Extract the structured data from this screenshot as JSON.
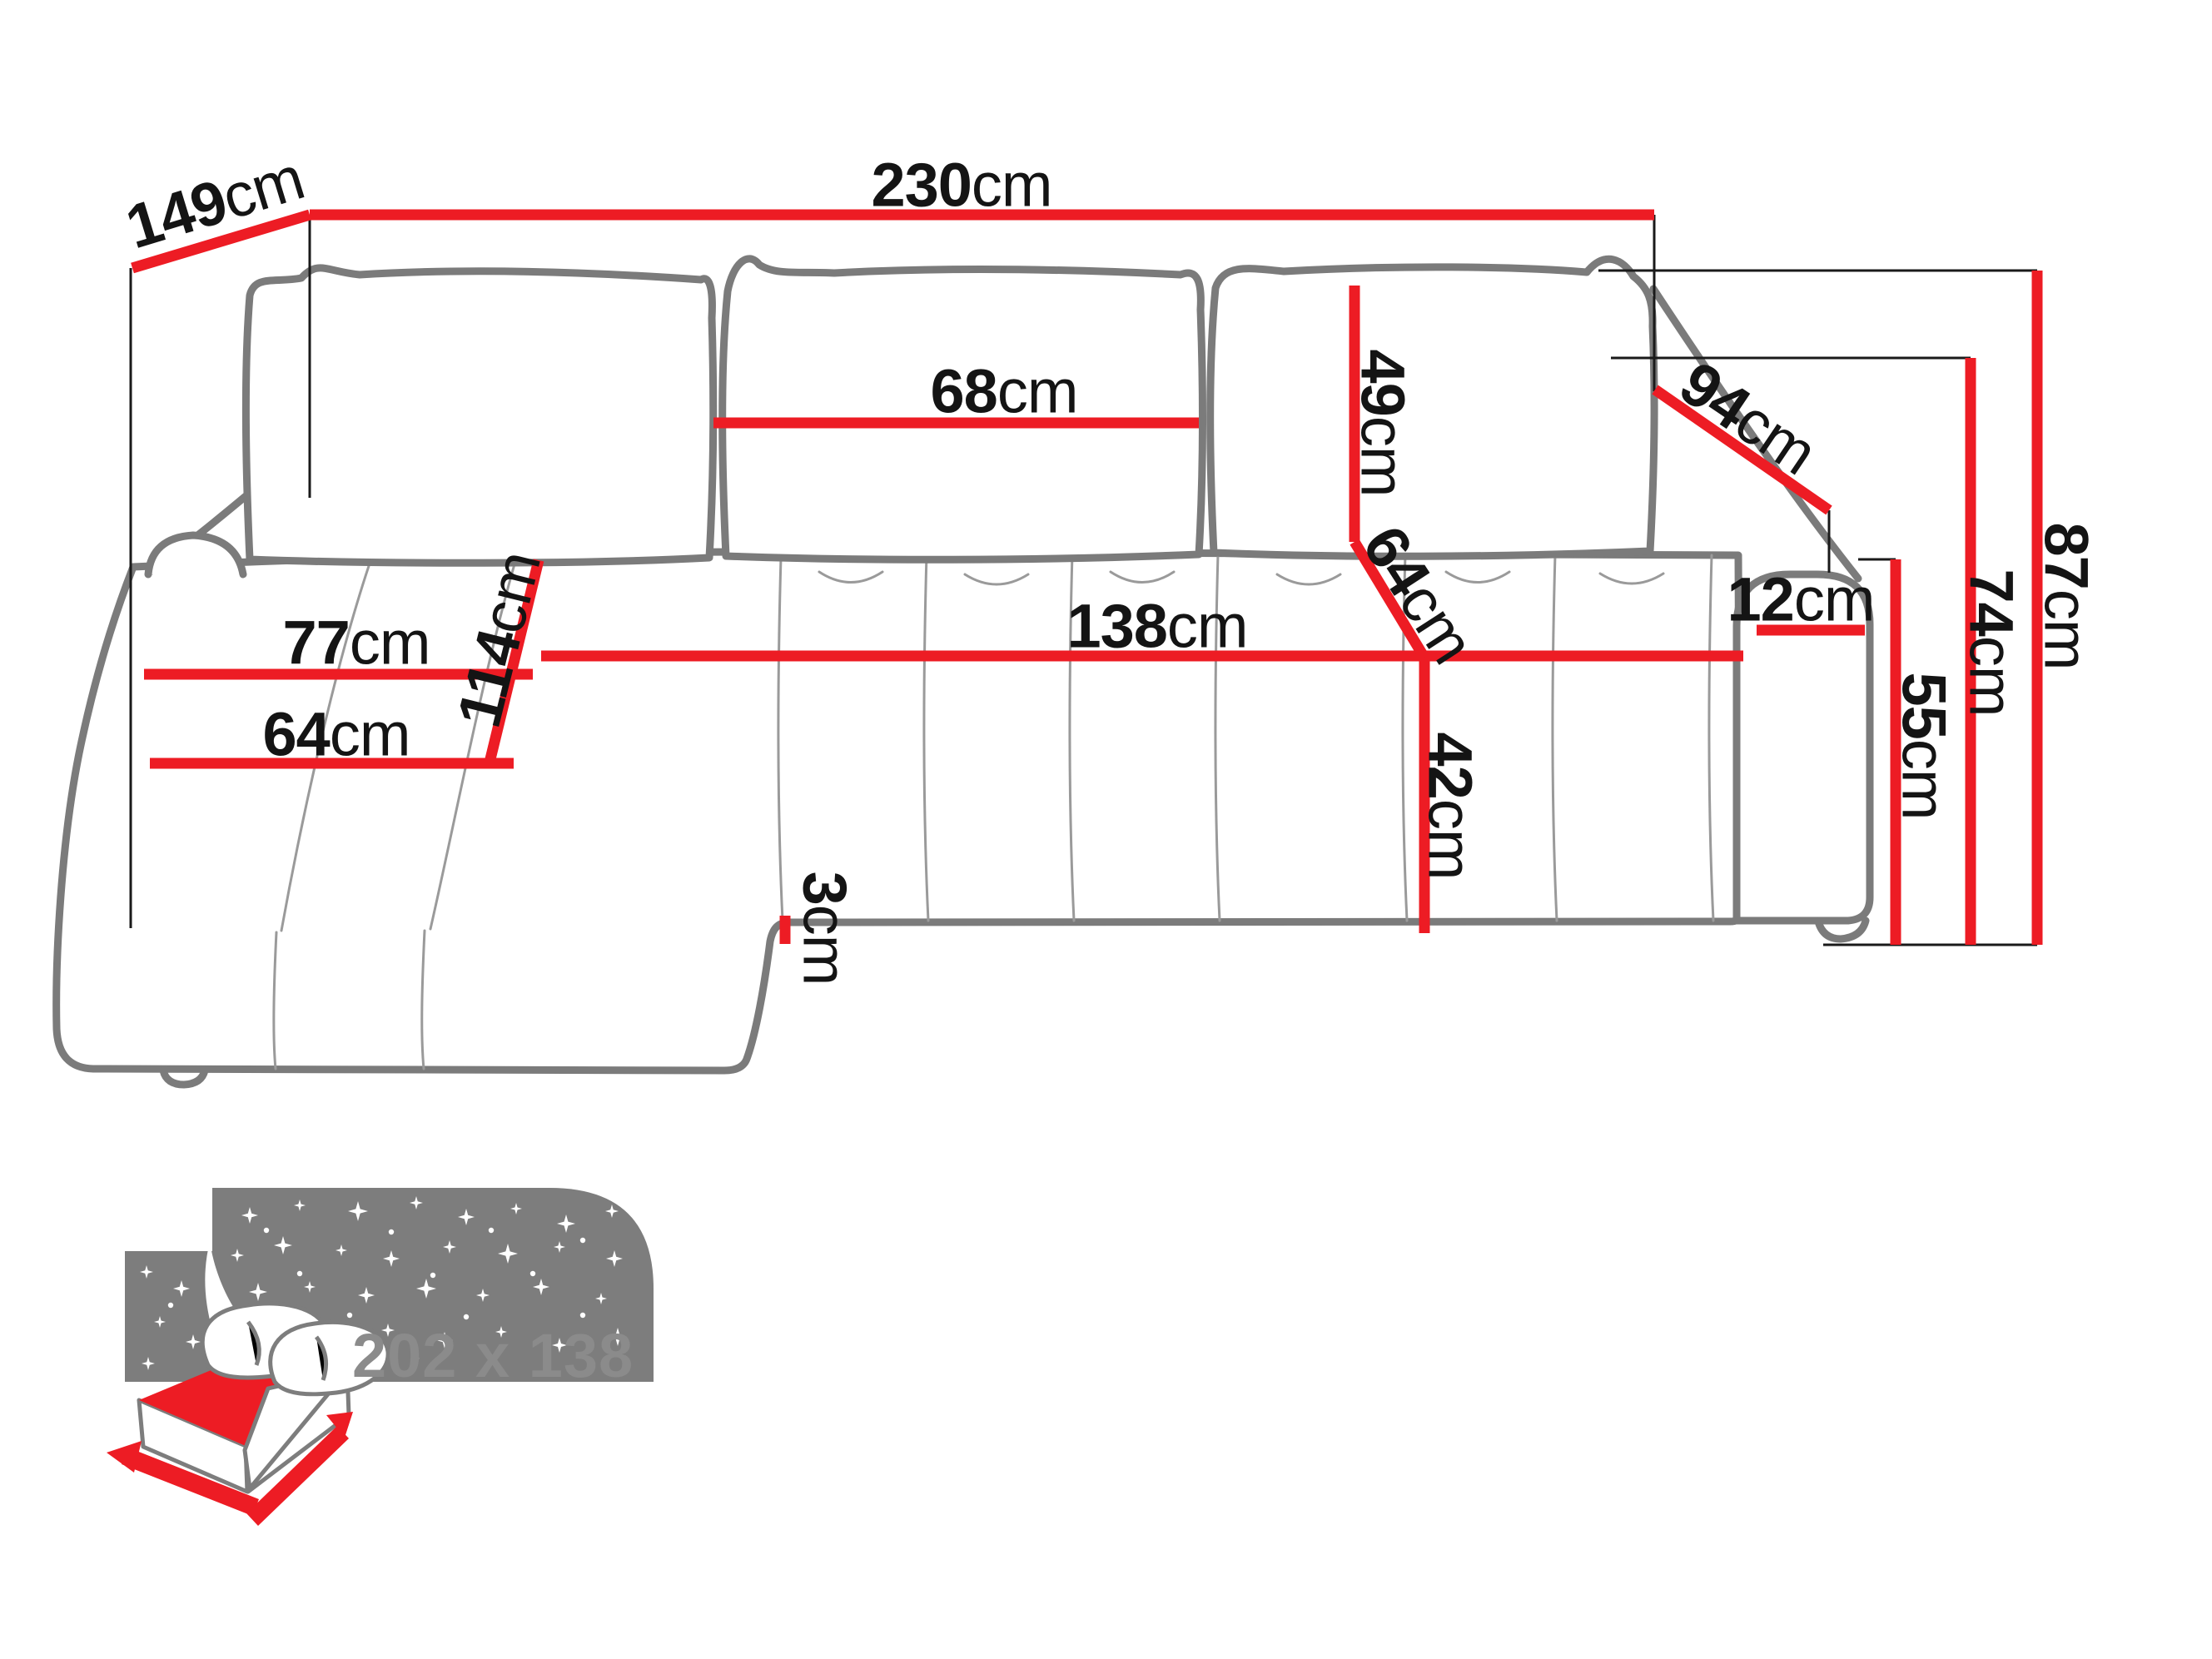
{
  "diagram": {
    "unit": "cm",
    "dims": {
      "depth_total": {
        "value": "149",
        "unit": "cm"
      },
      "width_total": {
        "value": "230",
        "unit": "cm"
      },
      "back_cushion_width": {
        "value": "68",
        "unit": "cm"
      },
      "back_cushion_height": {
        "value": "49",
        "unit": "cm"
      },
      "backrest_depth": {
        "value": "64",
        "unit": "cm"
      },
      "armrest_length": {
        "value": "94",
        "unit": "cm"
      },
      "armrest_width": {
        "value": "12",
        "unit": "cm"
      },
      "height_total": {
        "value": "87",
        "unit": "cm"
      },
      "armrest_height": {
        "value": "74",
        "unit": "cm"
      },
      "seat_front_height": {
        "value": "55",
        "unit": "cm"
      },
      "chaise_seat_width": {
        "value": "77",
        "unit": "cm"
      },
      "chaise_depth": {
        "value": "114",
        "unit": "cm"
      },
      "chaise_front_width": {
        "value": "64",
        "unit": "cm"
      },
      "seat_width": {
        "value": "138",
        "unit": "cm"
      },
      "seat_height": {
        "value": "42",
        "unit": "cm"
      },
      "bottom_clearance": {
        "value": "3",
        "unit": "cm"
      }
    },
    "sleeping_area": {
      "label": "202 x 138"
    },
    "colors": {
      "dimension_red": "#ed1c24",
      "sofa_outline_gray": "#7b7b7b",
      "seam_gray": "#9a9a9a",
      "label_black": "#141414",
      "icon_gray": "#7d7d7d",
      "icon_label_gray": "#8b8b8b"
    }
  }
}
